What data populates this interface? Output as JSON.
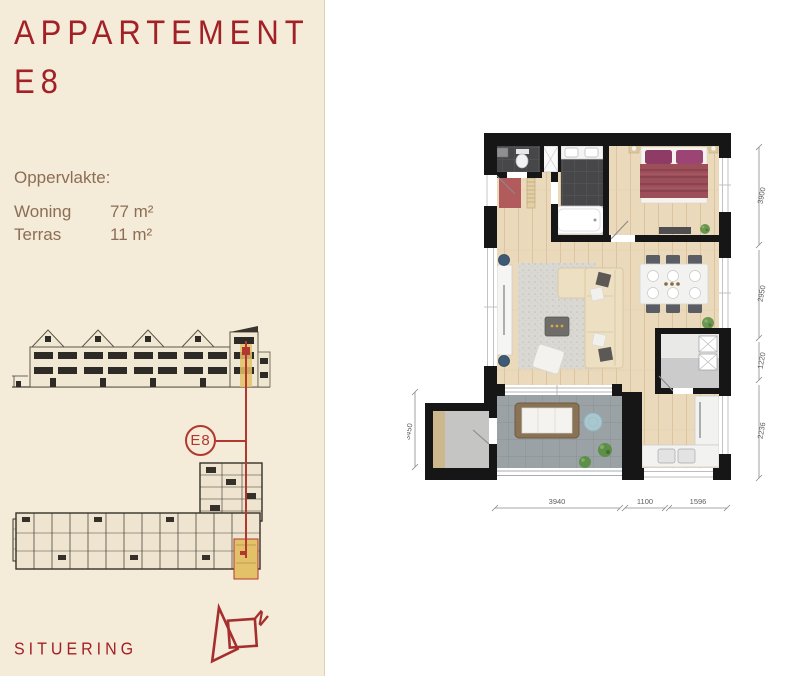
{
  "sidebar": {
    "background": "#f4ebd9",
    "accent_color": "#a22127",
    "text_color": "#8d6e54",
    "title_line1": "APPARTEMENT",
    "title_line2": "E8",
    "area": {
      "heading": "Oppervlakte:",
      "rows": [
        {
          "label": "Woning",
          "value": "77 m²"
        },
        {
          "label": "Terras",
          "value": "11 m²"
        }
      ]
    },
    "unit_badge": "E8",
    "situering_label": "SITUERING",
    "compass_letter": "N"
  },
  "floorplan": {
    "dims": {
      "bottom": [
        "3940",
        "1100",
        "1596"
      ],
      "left": [
        "3450"
      ],
      "right": [
        "3900",
        "2950",
        "1220",
        "2236"
      ]
    },
    "colors": {
      "wall": "#161616",
      "wood_floor": "#ead9bb",
      "dark_tile": "#47474a",
      "terrace_tile": "#9ba2a6",
      "highlight_yellow": "#e2c169",
      "marker_red": "#b2382f"
    }
  }
}
